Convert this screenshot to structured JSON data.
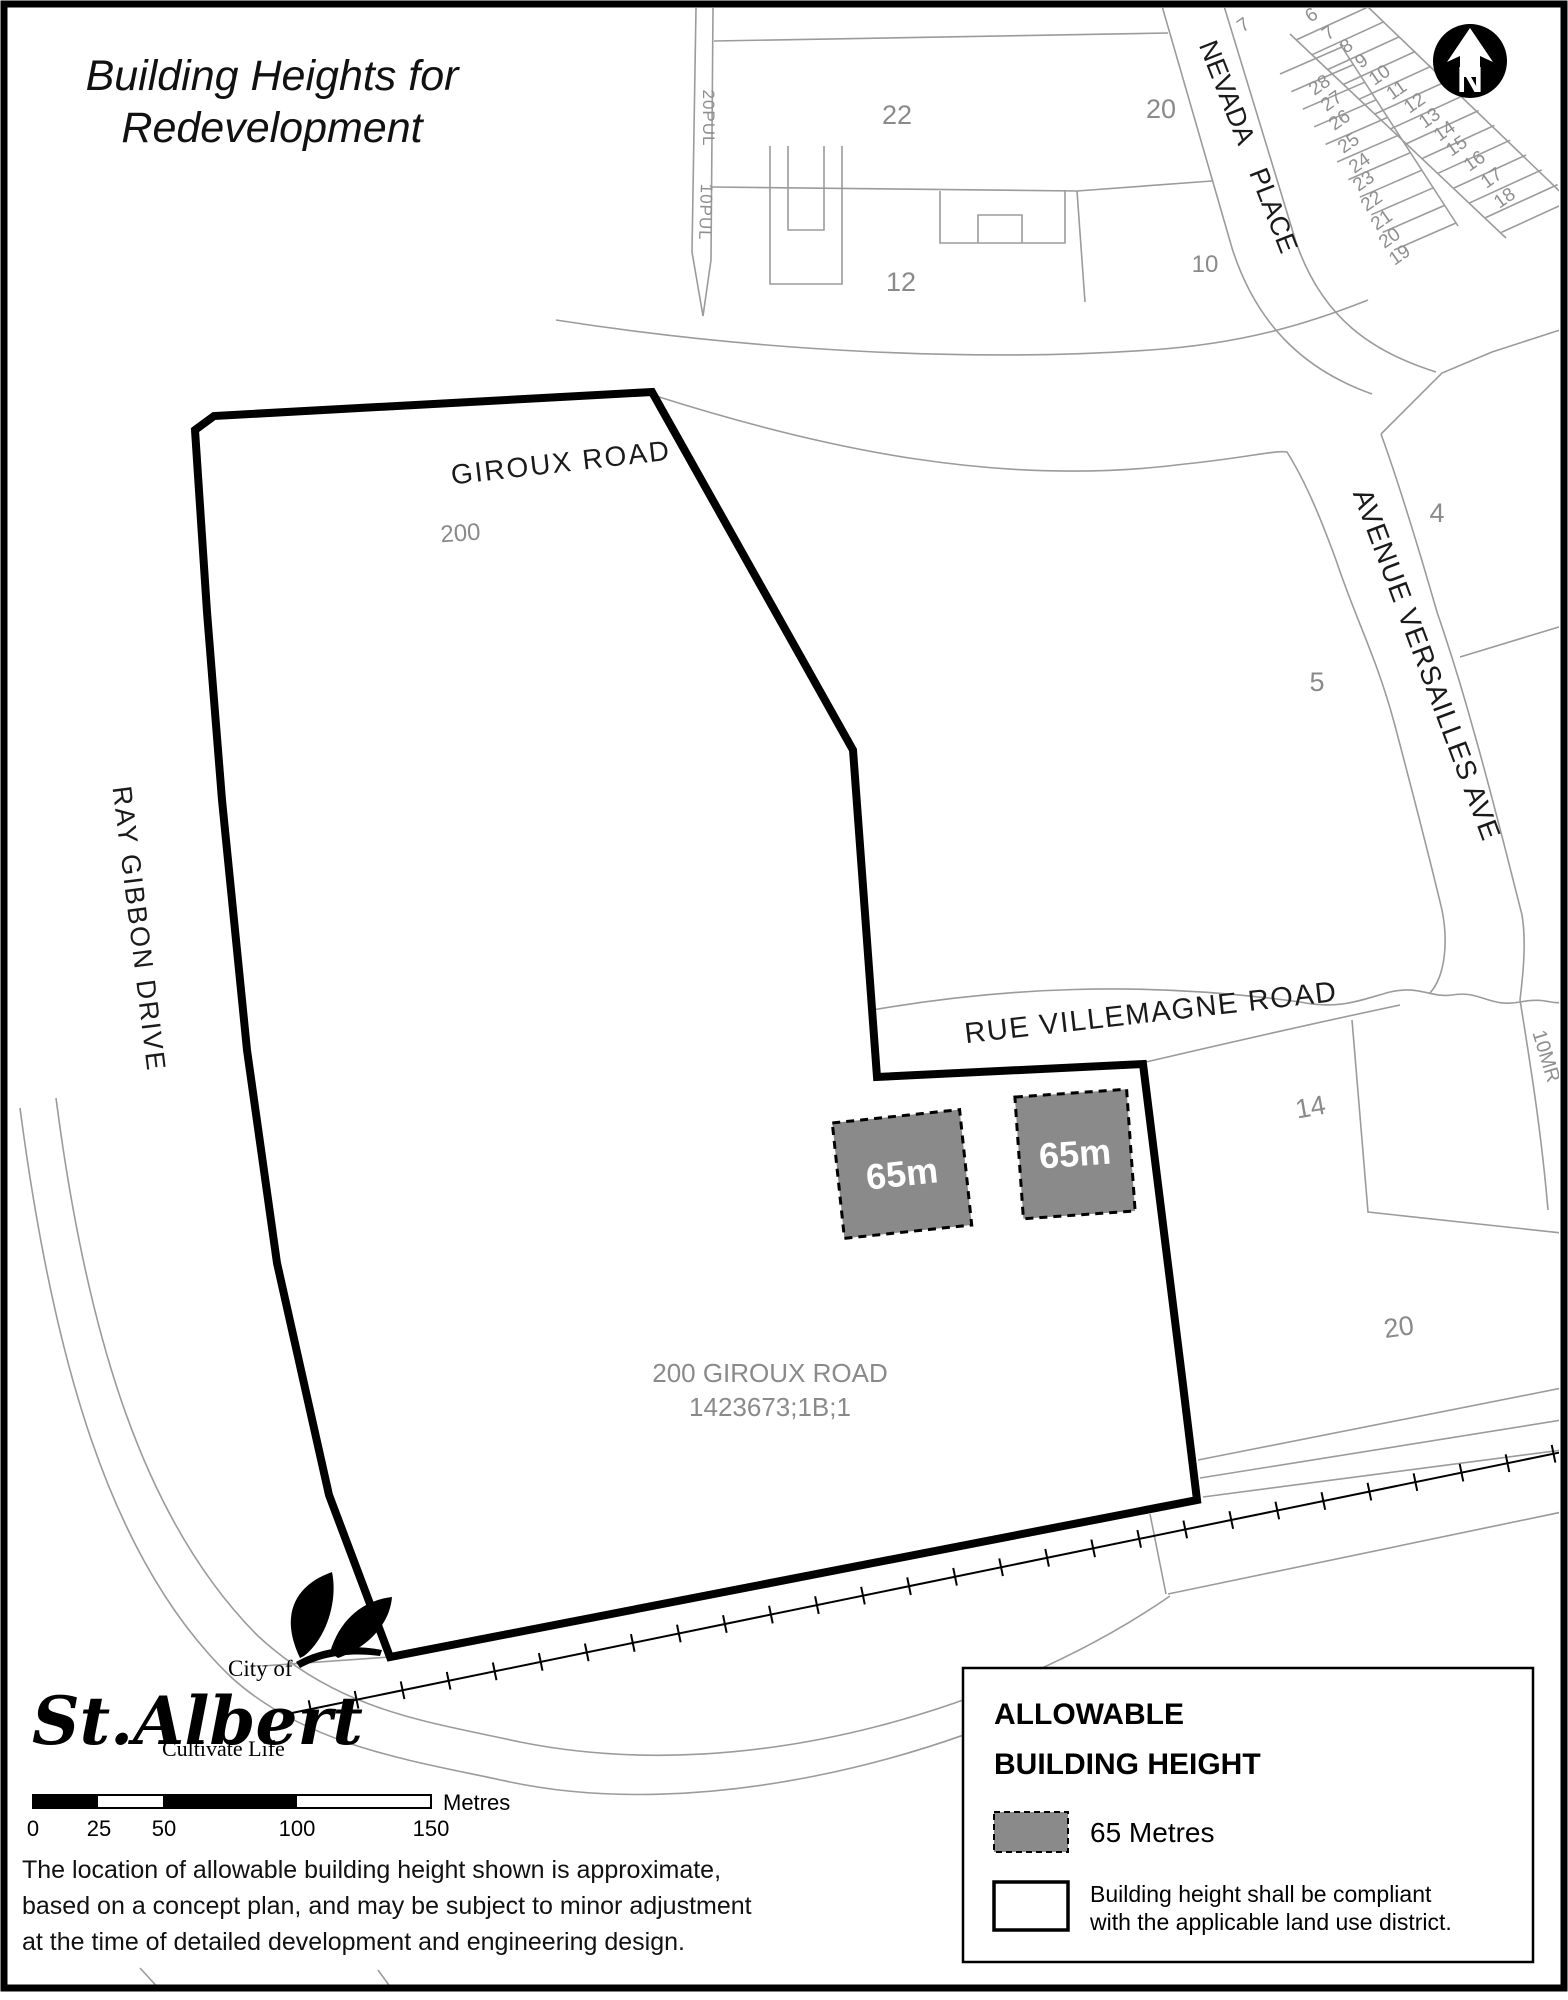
{
  "title": {
    "line1": "Building Heights for",
    "line2": "Redevelopment"
  },
  "map": {
    "road_labels": {
      "giroux": "GIROUX ROAD",
      "ray_gibbon": "RAY GIBBON DRIVE",
      "nevada": "NEVADA PLACE",
      "versailles": "AVENUE VERSAILLES AVE",
      "villemagne": "RUE VILLEMAGNE ROAD"
    },
    "parcels": {
      "n22": "22",
      "n20a": "20",
      "n12": "12",
      "n10": "10",
      "n7": "7",
      "n200": "200",
      "n4": "4",
      "n5": "5",
      "n14": "14",
      "n20b": "20",
      "pul20": "20PUL",
      "pul10": "10PUL",
      "mr10": "10MR"
    },
    "site": {
      "address": "200 GIROUX ROAD",
      "legal": "1423673;1B;1"
    },
    "height_boxes": [
      {
        "label": "65m"
      },
      {
        "label": "65m"
      }
    ],
    "lots_a": [
      "28",
      "27",
      "26",
      "25",
      "24",
      "23",
      "22",
      "21",
      "20",
      "19"
    ],
    "lots_b": [
      "6",
      "7",
      "8",
      "9",
      "10",
      "11",
      "12",
      "13",
      "14",
      "15",
      "16",
      "17",
      "18"
    ],
    "north": "N"
  },
  "legend": {
    "title_line1": "ALLOWABLE",
    "title_line2": "BUILDING HEIGHT",
    "items": [
      {
        "swatch": "gray-dashed-box",
        "label": "65 Metres"
      },
      {
        "swatch": "white-outline-box",
        "label_line1": "Building height shall be compliant",
        "label_line2": "with the applicable land use district."
      }
    ]
  },
  "logo": {
    "prefix": "City of",
    "name": "St.Albert",
    "tagline": "Cultivate Life"
  },
  "scale_bar": {
    "ticks": [
      "0",
      "25",
      "50",
      "100",
      "150"
    ],
    "unit": "Metres"
  },
  "disclaimer": {
    "line1": "The location of allowable building height shown is approximate,",
    "line2": "based on a concept plan, and may be subject to minor adjustment",
    "line3": "at the time of detailed development and engineering design."
  },
  "colors": {
    "height_box_fill": "#8a8a8a",
    "parcel_text": "#8a8a8a",
    "line_gray": "#9b9b9b"
  }
}
